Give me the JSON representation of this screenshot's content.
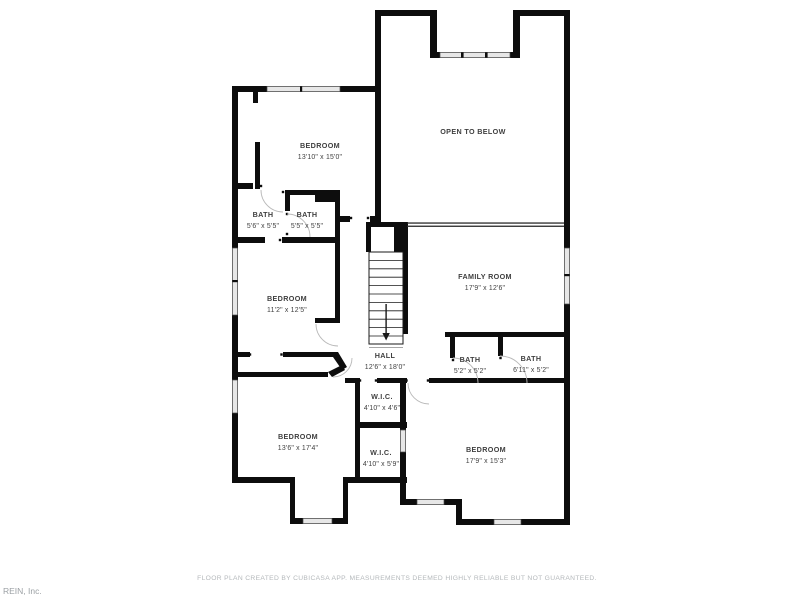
{
  "document": {
    "type": "floor-plan",
    "footer_note": "FLOOR PLAN CREATED BY CUBICASA APP. MEASUREMENTS DEEMED HIGHLY RELIABLE BUT NOT GUARANTEED.",
    "watermark": "REIN, Inc."
  },
  "colors": {
    "background": "#ffffff",
    "wall": "#0d0d0d",
    "window_fill": "#e7e7e7",
    "window_edge": "#4a4a4a",
    "railing": "#2a2a2a",
    "stair_line": "#1a1a1a",
    "label": "#3f3f3f",
    "arc": "#b9b9b9",
    "muted": "#b4b8bb",
    "watermark": "#9ba0a4"
  },
  "rooms": [
    {
      "name": "BEDROOM",
      "dims": "13'10\" x 15'0\""
    },
    {
      "name": "OPEN TO BELOW",
      "dims": ""
    },
    {
      "name": "BATH",
      "dims": "5'6\" x 5'5\""
    },
    {
      "name": "BATH",
      "dims": "5'5\" x 5'5\""
    },
    {
      "name": "FAMILY ROOM",
      "dims": "17'9\" x 12'6\""
    },
    {
      "name": "BEDROOM",
      "dims": "11'2\" x 12'5\""
    },
    {
      "name": "HALL",
      "dims": "12'6\" x 18'0\""
    },
    {
      "name": "BATH",
      "dims": "5'2\" x 5'2\""
    },
    {
      "name": "BATH",
      "dims": "6'11\" x 5'2\""
    },
    {
      "name": "W.I.C.",
      "dims": "4'10\" x 4'6\""
    },
    {
      "name": "W.I.C.",
      "dims": "4'10\" x 5'9\""
    },
    {
      "name": "BEDROOM",
      "dims": "13'6\" x 17'4\""
    },
    {
      "name": "BEDROOM",
      "dims": "17'9\" x 15'3\""
    }
  ]
}
